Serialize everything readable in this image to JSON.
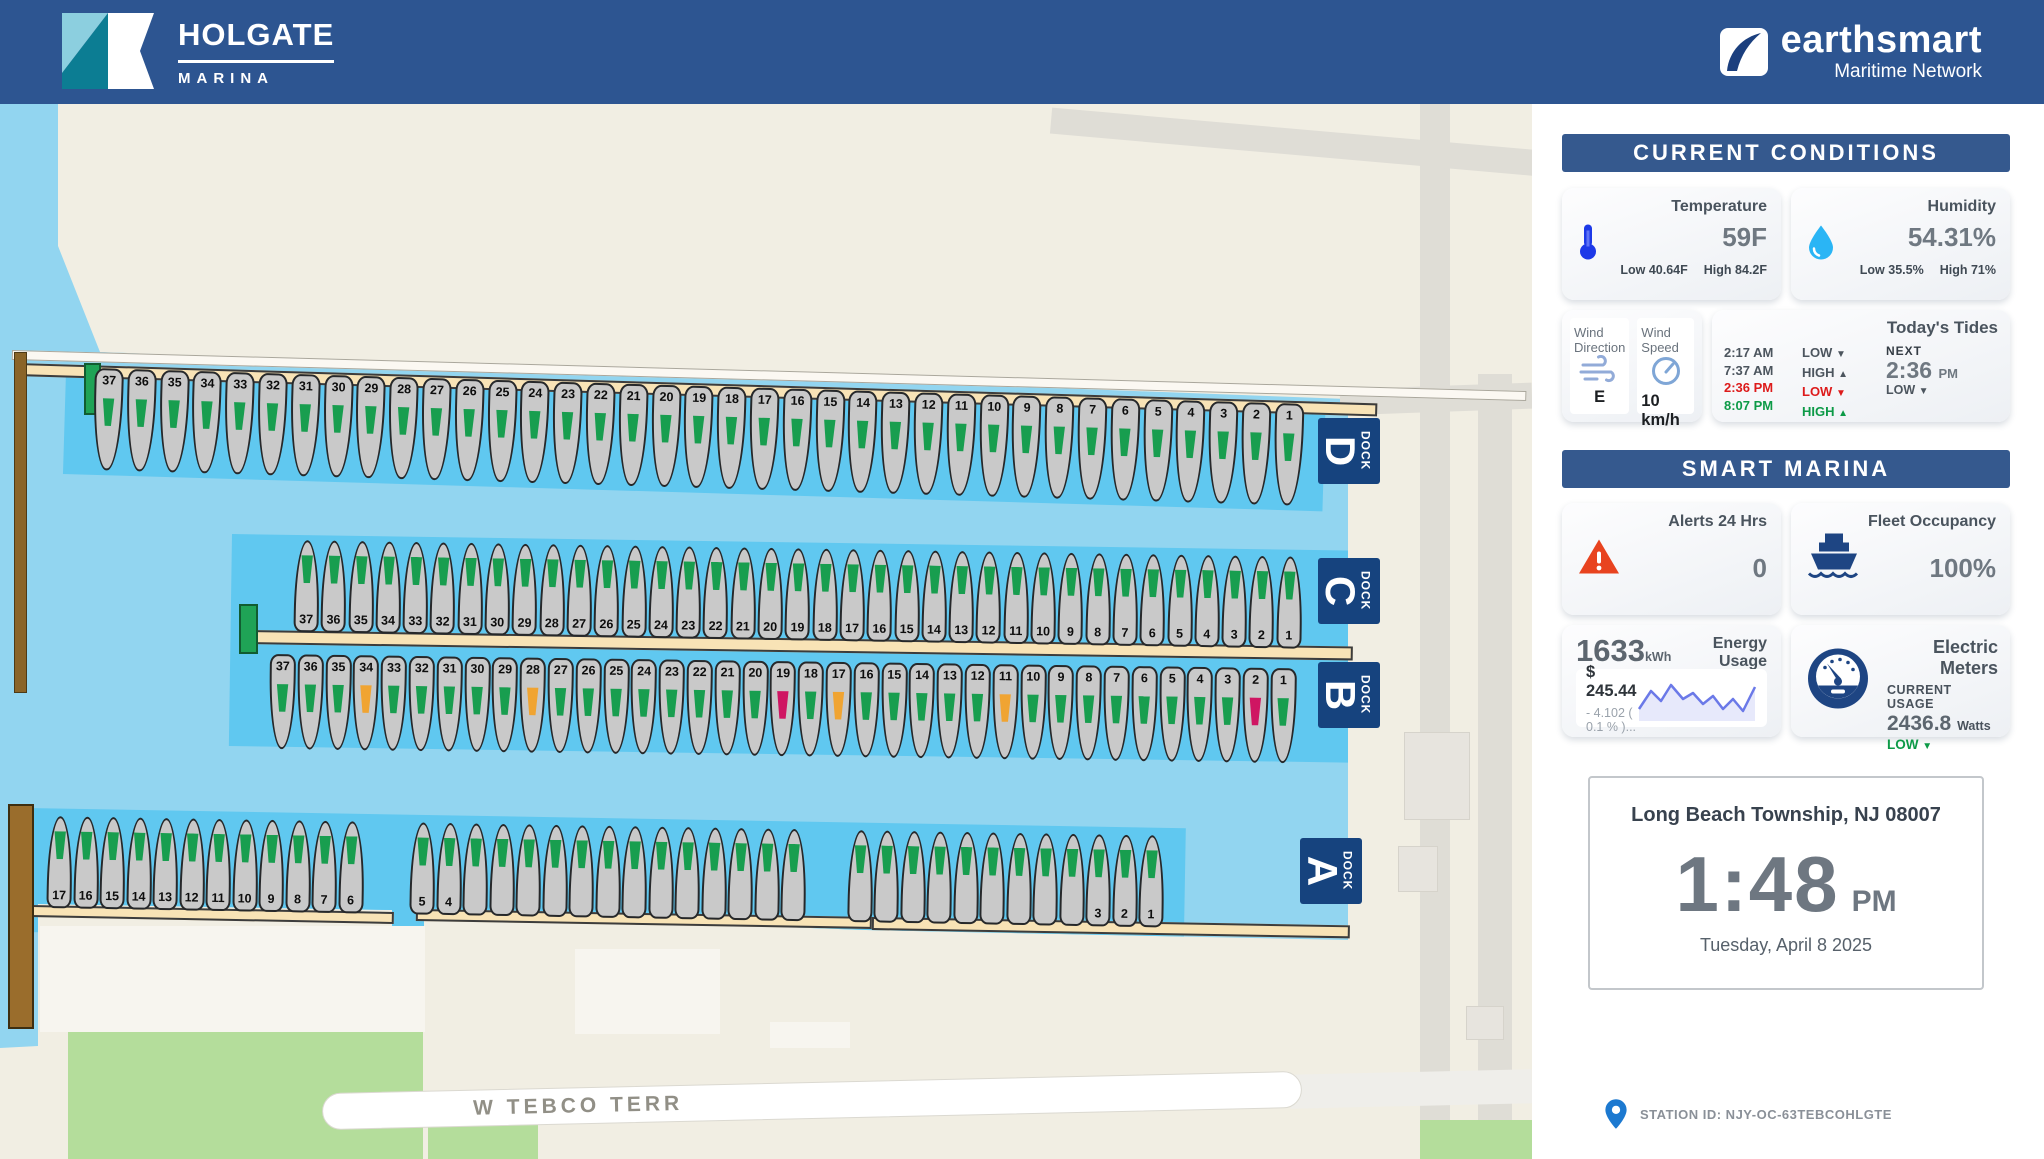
{
  "header": {
    "marina_name": "HOLGATE",
    "marina_tagline": "MARINA",
    "network_name": "earthsmart",
    "network_tagline": "Maritime Network"
  },
  "conditions": {
    "title": "CURRENT CONDITIONS",
    "temperature": {
      "label": "Temperature",
      "value": "59F",
      "low_label": "Low",
      "low": "40.64F",
      "high_label": "High",
      "high": "84.2F"
    },
    "humidity": {
      "label": "Humidity",
      "value": "54.31%",
      "low_label": "Low",
      "low": "35.5%",
      "high_label": "High",
      "high": "71%"
    },
    "wind_direction": {
      "label": "Wind Direction",
      "value": "E"
    },
    "wind_speed": {
      "label": "Wind Speed",
      "value": "10 km/h"
    },
    "tides": {
      "title": "Today's Tides",
      "rows": [
        {
          "time": "2:17 AM",
          "status": "LOW",
          "arrow": "▼"
        },
        {
          "time": "7:37 AM",
          "status": "HIGH",
          "arrow": "▲"
        },
        {
          "time": "2:36 PM",
          "status": "LOW",
          "arrow": "▼"
        },
        {
          "time": "8:07 PM",
          "status": "HIGH",
          "arrow": "▲"
        }
      ],
      "next_label": "NEXT",
      "next_time": "2:36",
      "next_meridiem": "PM",
      "next_status": "LOW",
      "next_arrow": "▼"
    }
  },
  "smart_marina": {
    "title": "SMART MARINA",
    "alerts": {
      "label": "Alerts 24 Hrs",
      "value": "0"
    },
    "fleet": {
      "label": "Fleet Occupancy",
      "value": "100%"
    },
    "energy": {
      "label": "Energy Usage",
      "value": "1633",
      "unit": "kWh",
      "cost": "$ 245.44",
      "delta": "- 4.102 ( 0.1 % )..."
    },
    "meters": {
      "label": "Electric Meters",
      "usage_label": "CURRENT USAGE",
      "usage_value": "2436.8",
      "usage_unit": "Watts",
      "trend": "LOW",
      "trend_arrow": "▼"
    }
  },
  "clock": {
    "location": "Long Beach Township, NJ 08007",
    "time": "1:48",
    "meridiem": "PM",
    "date": "Tuesday, April 8 2025"
  },
  "station": {
    "label": "STATION ID: NJY-OC-63TEBCOHLGTE"
  },
  "map": {
    "street": "W TEBCO TERR",
    "marker_colors": {
      "g": "#189e4f",
      "o": "#f0a432",
      "p": "#cf1562"
    },
    "docks": [
      {
        "id": "D",
        "letter": "D",
        "word": "DOCK",
        "dir": "down",
        "start": 37,
        "end": 1,
        "colors": {}
      },
      {
        "id": "C",
        "letter": "C",
        "word": "DOCK",
        "dir": "up",
        "start": 37,
        "end": 1,
        "colors": {}
      },
      {
        "id": "B",
        "letter": "B",
        "word": "DOCK",
        "dir": "down",
        "start": 37,
        "end": 1,
        "colors": {
          "34": "o",
          "28": "o",
          "19": "p",
          "17": "o",
          "11": "o",
          "2": "p"
        }
      },
      {
        "id": "A",
        "letter": "A",
        "word": "DOCK",
        "dir": "up",
        "gaps": [
          45,
          40
        ],
        "groups": [
          {
            "labels": [
              "17",
              "16",
              "15",
              "14",
              "13",
              "12",
              "11",
              "10",
              "9",
              "8",
              "7",
              "6"
            ]
          },
          {
            "labels": [
              "5",
              "4",
              "",
              "",
              "",
              "",
              "",
              "",
              "",
              "",
              "",
              "",
              "",
              "",
              ""
            ]
          },
          {
            "labels": [
              "",
              "",
              "",
              "",
              "",
              "",
              "",
              "",
              "",
              "3",
              "2",
              "1"
            ]
          }
        ]
      }
    ]
  }
}
